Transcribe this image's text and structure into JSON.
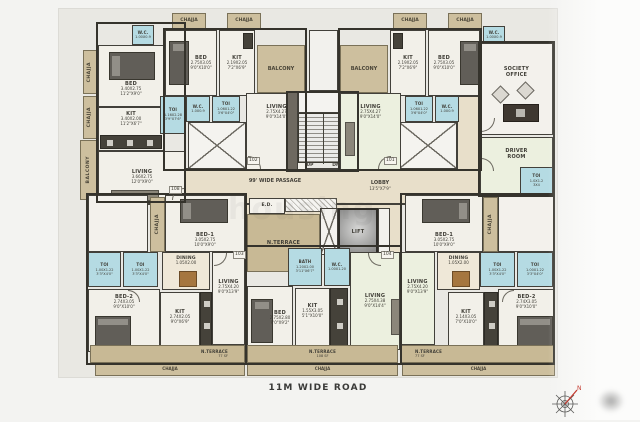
{
  "common": {
    "chajja": "CHAJJA",
    "balcony": "BALCONY",
    "up": "UP",
    "dn": "DN",
    "ed": "E.D.",
    "lift": "LIFT",
    "nterrace": "N.TERRACE",
    "passage": "99' WIDE PASSAGE",
    "lobby": "LOBBY",
    "lobby_dim": "13'5\"X7'9\"",
    "road": "11M WIDE ROAD",
    "north": "N",
    "watermark": "housing"
  },
  "doors": {
    "d101": "101",
    "d102": "102",
    "d103": "103",
    "d104": "104",
    "d108": "108"
  },
  "office": {
    "n1": "SOCIETY",
    "n2": "OFFICE"
  },
  "driver": {
    "n1": "DRIVER",
    "n2": "ROOM"
  },
  "rooms": {
    "a_wc": {
      "n": "W.C.",
      "m": "1.00X0.9"
    },
    "a_bed": {
      "n": "BED",
      "m": "3.40X2.75",
      "f": "11'2\"X9'0\""
    },
    "a_kit": {
      "n": "KIT",
      "m": "3.40X2.00",
      "f": "11'2\"X6'7\""
    },
    "a_toi": {
      "n": "TOI",
      "m": "1.16X2.28",
      "f": "3'9\"X7'6\""
    },
    "a_living": {
      "n": "LIVING",
      "m": "3.66X2.75",
      "f": "12'0\"X9'0\""
    },
    "b_bed": {
      "n": "BED",
      "m": "2.75X3.05",
      "f": "9'0\"X10'0\""
    },
    "b_kit": {
      "n": "KIT",
      "m": "2.19X2.05",
      "f": "7'2\"X6'9\""
    },
    "b_wc": {
      "n": "W.C.",
      "m": "1.0X0.9"
    },
    "b_toi": {
      "n": "TOI",
      "m": "1.06X1.22",
      "f": "3'6\"X4'0\""
    },
    "b_living": {
      "n": "LIVING",
      "m": "2.75X4.27",
      "f": "9'0\"X14'0\""
    },
    "c_kit": {
      "n": "KIT",
      "m": "2.19X2.05",
      "f": "7'2\"X6'9\""
    },
    "c_bed": {
      "n": "BED",
      "m": "2.75X3.05",
      "f": "9'0\"X10'0\""
    },
    "c_wc_top": {
      "n": "W.C.",
      "m": "1.00X0.9"
    },
    "c_toi": {
      "n": "TOI",
      "m": "1.06X1.22",
      "f": "3'6\"X4'0\""
    },
    "c_wc": {
      "n": "W.C.",
      "m": "1.0X0.9"
    },
    "c_living": {
      "n": "LIVING",
      "m": "2.75X4.27",
      "f": "9'0\"X14'0\""
    },
    "dr_toi": {
      "n": "TOI",
      "m": "1.0X1.2",
      "f": "3X4"
    },
    "d_bed1": {
      "n": "BED-1",
      "m": "3.05X2.75",
      "f": "10'0\"X9'0\""
    },
    "d_toi1": {
      "n": "TOI",
      "m": "1.00X1.22",
      "f": "3'3\"X4'0\""
    },
    "d_toi2": {
      "n": "TOI",
      "m": "1.00X1.22",
      "f": "3'3\"X4'0\""
    },
    "d_dining": {
      "n": "DINING",
      "m": "1.05X2.00"
    },
    "d_living": {
      "n": "LIVING",
      "m": "2.75X4.20",
      "f": "9'0\"X13'9\""
    },
    "d_bed2": {
      "n": "BED-2",
      "m": "2.74X3.05",
      "f": "9'0\"X10'0\""
    },
    "d_kit": {
      "n": "KIT",
      "m": "2.74X2.05",
      "f": "9'0\"X6'9\""
    },
    "d_terr": {
      "n": "N.TERRACE",
      "s": "77 SF"
    },
    "e_bath": {
      "n": "BATH",
      "m": "1.20X2.00",
      "f": "3'11\"X6'7\""
    },
    "e_wc": {
      "n": "W.C.",
      "m": "1.00X1.20"
    },
    "e_bed": {
      "n": "BED",
      "m": "2.75X2.80",
      "f": "9'0\"X9'2\""
    },
    "e_kit": {
      "n": "KIT",
      "m": "1.55X3.05",
      "f": "5'1\"X10'0\""
    },
    "e_living": {
      "n": "LIVING",
      "m": "2.75X4.38",
      "f": "9'0\"X14'4\""
    },
    "e_terr": {
      "n": "N.TERRACE",
      "s": "108 SF"
    },
    "f_living": {
      "n": "LIVING",
      "m": "2.75X4.20",
      "f": "9'0\"X13'9\""
    },
    "f_dining": {
      "n": "DINING",
      "m": "1.05X2.00"
    },
    "f_bed1": {
      "n": "BED-1",
      "m": "3.05X2.75",
      "f": "10'0\"X9'0\""
    },
    "f_toi1": {
      "n": "TOI",
      "m": "1.00X1.22",
      "f": "3'3\"X4'0\""
    },
    "f_toi2": {
      "n": "TOI",
      "m": "1.00X1.22",
      "f": "3'3\"X4'0\""
    },
    "f_kit": {
      "n": "KIT",
      "m": "2.14X3.05",
      "f": "7'0\"X10'0\""
    },
    "f_bed2": {
      "n": "BED-2",
      "m": "2.74X3.05",
      "f": "9'0\"X10'0\""
    },
    "f_terr": {
      "n": "N.TERRACE",
      "s": "77 SF"
    }
  }
}
